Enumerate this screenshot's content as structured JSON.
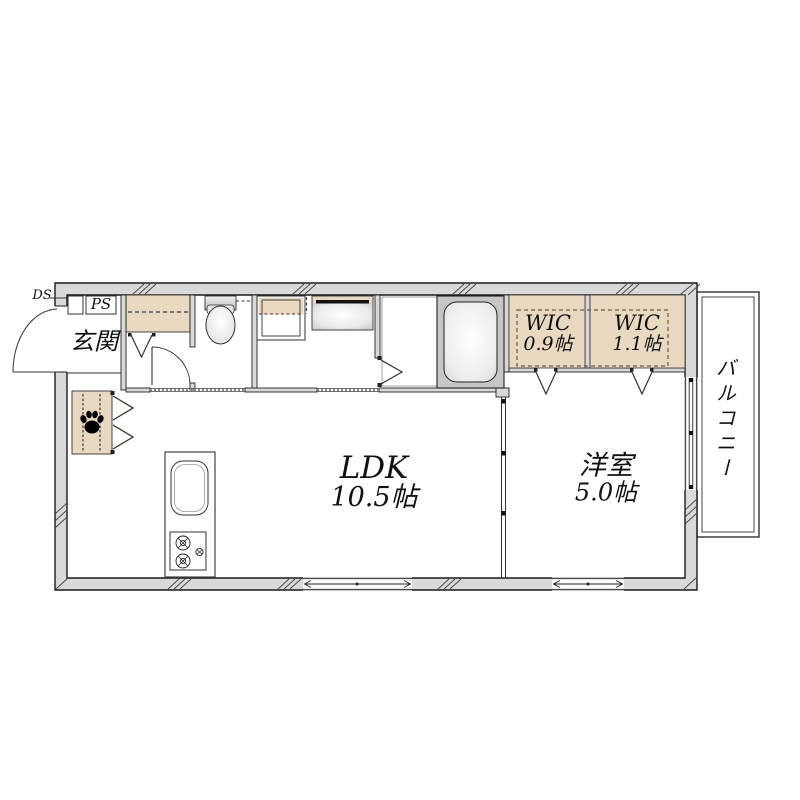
{
  "plan_title": "1LDK floor plan",
  "labels": {
    "ds": "DS",
    "ps": "PS",
    "entrance": "玄関",
    "wic_left_name": "WIC",
    "wic_left_size": "0.9帖",
    "wic_right_name": "WIC",
    "wic_right_size": "1.1帖",
    "ldk_name": "LDK",
    "ldk_size": "10.5帖",
    "bedroom_name": "洋室",
    "bedroom_size": "5.0帖",
    "balcony": "バルコニー"
  },
  "rooms": [
    {
      "name": "LDK",
      "size": "10.5帖"
    },
    {
      "name": "洋室",
      "size": "5.0帖"
    },
    {
      "name": "WIC",
      "size": "0.9帖"
    },
    {
      "name": "WIC",
      "size": "1.1帖"
    },
    {
      "name": "玄関",
      "size": ""
    },
    {
      "name": "バルコニー",
      "size": ""
    },
    {
      "name": "PS",
      "size": ""
    },
    {
      "name": "DS",
      "size": ""
    }
  ],
  "icons": {
    "pet_space": "paw-print-icon"
  },
  "colors": {
    "tan": "#e9d9c1",
    "wall_fill": "#d9d9d9",
    "fixture_gray": "#c7c7c7",
    "line": "#1a1a1a"
  }
}
